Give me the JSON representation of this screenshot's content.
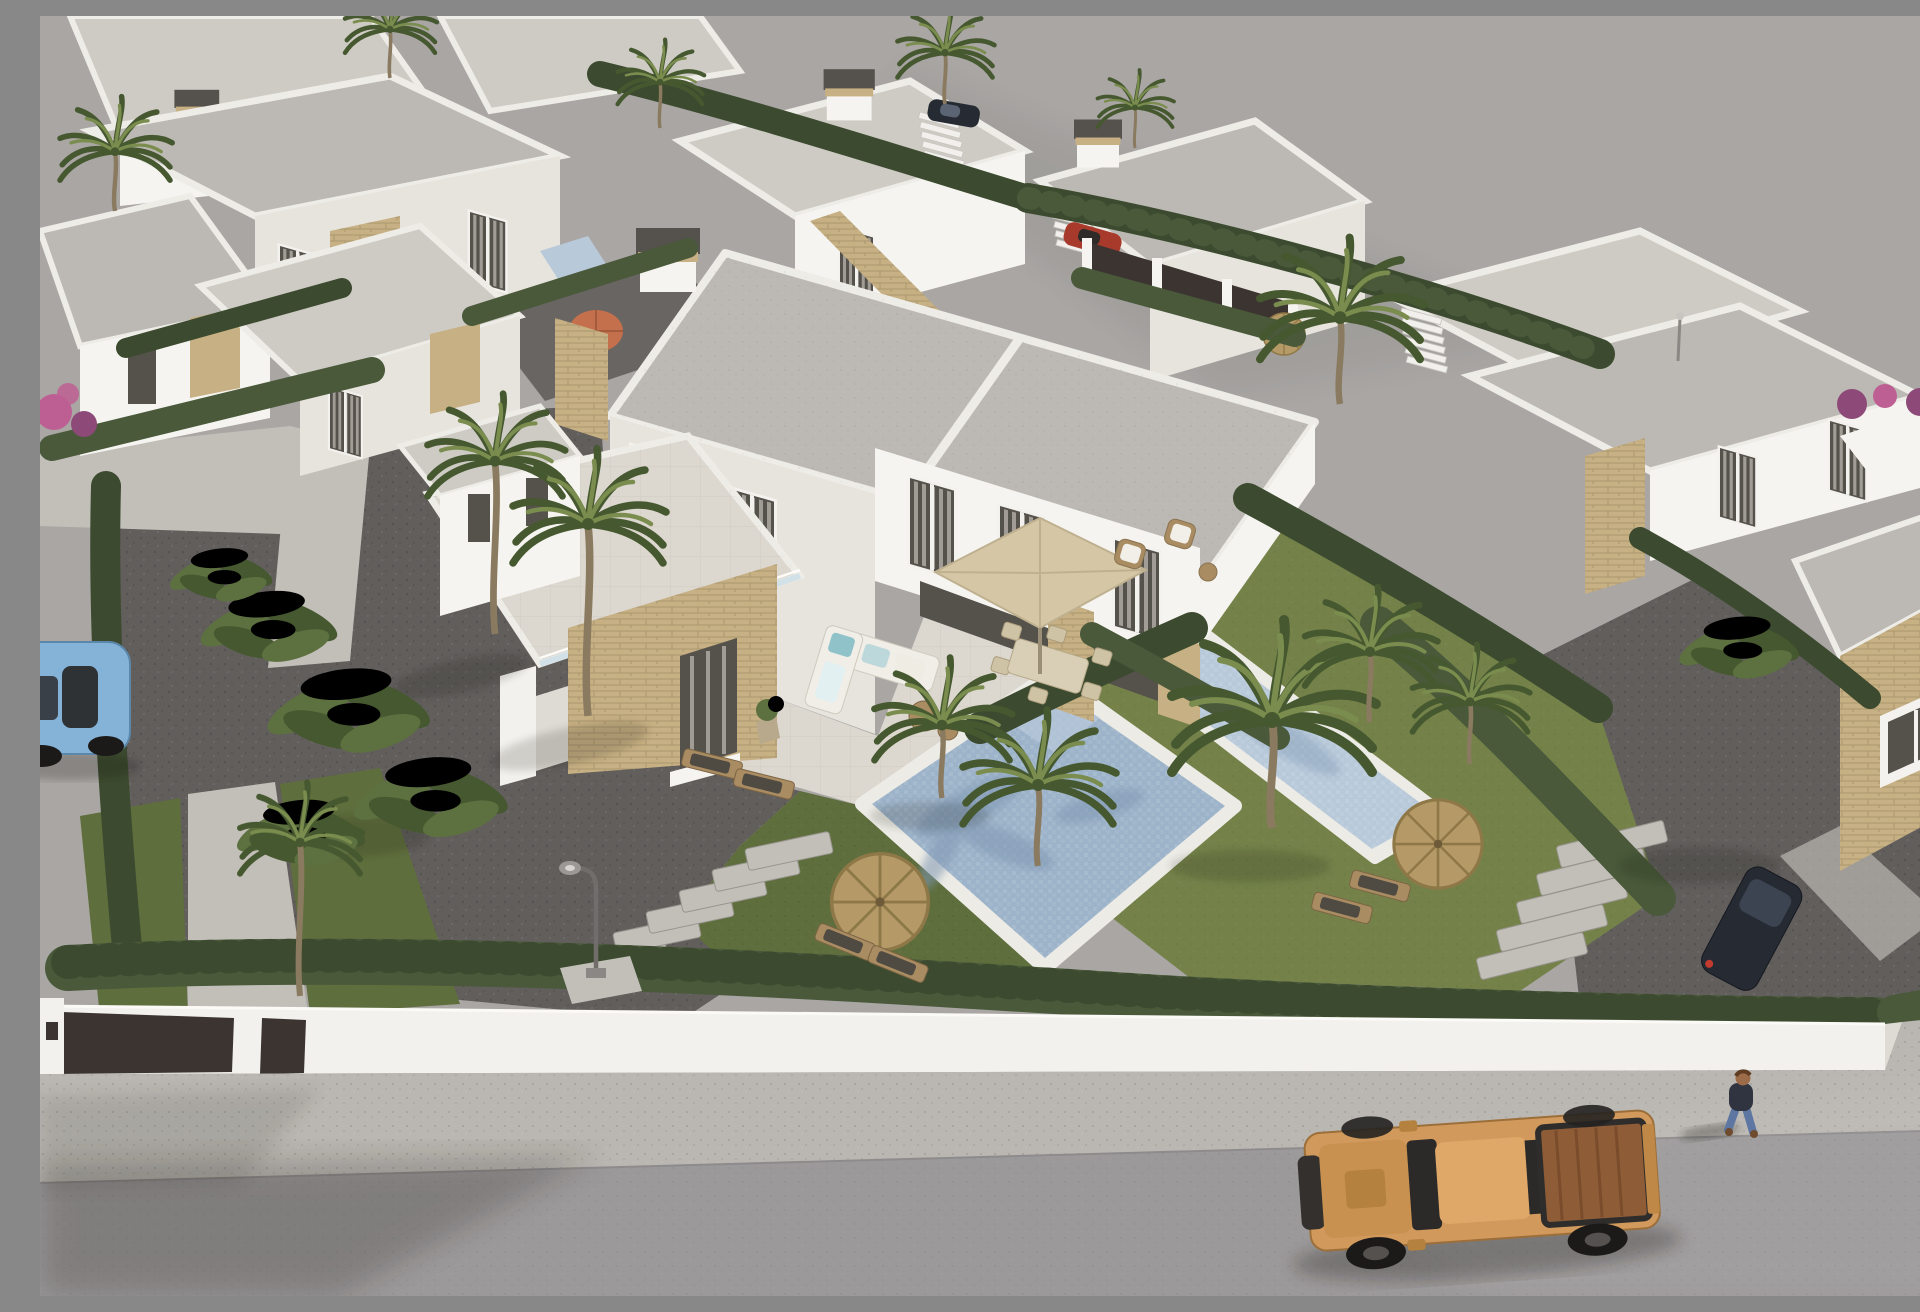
{
  "scene": {
    "title": "Aerial 3D architectural rendering of a modern white villa development",
    "description": "Photorealistic bird's-eye render of a residential complex of flat-roofed white villas with sandstone accent walls. A central two-storey duplex villa has a tiled terrace, an L-shaped outdoor sofa, a square beige parasol over a dining set, sun loungers, a mosaic-tiled swimming pool and a lawn with a straw parasol. A second elongated pool lies in the neighbouring garden to the right. Rows of cypress hedges, fan palms and banana plants divide the plots. A white perimeter wall with dark entrance gates runs along a grey asphalt street where a tan pickup truck drives past; a light-blue convertible is parked at the left edge and a pedestrian walks on the sidewalk at the lower right. The upper right of the frame is an empty grey lot.",
    "style": "photorealistic 3D visualization",
    "camera": "high aerial three-quarter view",
    "time_of_day": "bright daylight, low warm sun from the right"
  },
  "palette": {
    "bgGround": "#a9a6a4",
    "street": "#9c999a",
    "sidewalk": "#bab7b2",
    "curb": "#8e8b8c",
    "wallWhite": "#f3f1ed",
    "wallShade": "#dedbd5",
    "gateDark": "#3b3430",
    "gravelDark": "#615e5c",
    "gravelLight": "#b3b0ab",
    "pathLight": "#c2bfb9",
    "lawn": "#5f6e3d",
    "lawnLight": "#74824a",
    "hedge": "#49593a",
    "hedgeDark": "#3c4b2f",
    "roofGray": "#bcb9b4",
    "roofLight": "#cecbc5",
    "whiteWall": "#f6f4f0",
    "whiteShade": "#e7e4de",
    "whiteDark": "#d7d4cd",
    "parapet": "#eeece7",
    "stoneTan": "#c7b083",
    "stoneDark": "#a8906a",
    "glassDark": "#55514b",
    "curtain": "#b5b1a9",
    "glassBlue": "#cfe0e8",
    "deck": "#dcd7cf",
    "deckWarm": "#d2cdc4",
    "poolBlue": "#9db3c9",
    "poolLight": "#b8c9da",
    "poolDark": "#7e97b2",
    "coping": "#ecebe5",
    "umbBeige": "#d5c7a5",
    "umbStraw": "#b59a67",
    "umbStrawDark": "#8f7848",
    "umbOrange": "#c4704c",
    "woodTan": "#a98c62",
    "truckOrange": "#d1995c",
    "truckDark": "#33302d",
    "truckBed": "#8e5c36",
    "carBlue": "#85b3d8",
    "carRed": "#a83a2c",
    "carDark": "#262a33",
    "skin": "#9c6b4a",
    "navyShirt": "#2f3440",
    "jeans": "#5d77a2",
    "whiteShirt": "#e9e7e3",
    "pink": "#bd5f93",
    "purple": "#8d4a78",
    "trunk": "#8a7a5f",
    "palmGreen": "#5d7040",
    "palmDark": "#46582f",
    "palmLight": "#7a8d4e"
  },
  "objects": {
    "central_villa": {
      "label": "central duplex villa",
      "features": [
        "flat gravel roof with white parapets and centre divider",
        "dark chimney cap with stone collar",
        "two-storey white facade with tall curtained windows",
        "sandstone accent volume with dark doorway",
        "roof terrace with glass balustrade over single-storey annex",
        "recessed terrace with stone piers"
      ]
    },
    "pools": [
      {
        "name": "central-pool",
        "description": "square mosaic-tiled pool with palm shadow on the water and white coping"
      },
      {
        "name": "right-garden-pool",
        "description": "elongated mosaic pool in the neighbouring garden"
      },
      {
        "name": "background-plunge-pool",
        "description": "small plunge pool in the rear garden with orange parasol"
      }
    ],
    "furniture": [
      {
        "name": "outdoor-sofa",
        "description": "white L-shaped lounge sofa with teal cushions and two round coffee tables"
      },
      {
        "name": "dining-parasol",
        "description": "square beige cantilever parasol over an outdoor dining table with chairs"
      },
      {
        "name": "armchair-set",
        "description": "two rattan armchairs with white cushions on the raised terrace"
      },
      {
        "name": "deck-loungers",
        "description": "pair of beige sun loungers on the terrace"
      },
      {
        "name": "straw-parasol-central",
        "description": "round straw parasol with two wooden loungers on the lawn"
      },
      {
        "name": "straw-parasol-right",
        "description": "round straw parasol with wooden loungers in the right garden"
      },
      {
        "name": "straw-parasol-back",
        "description": "small straw parasol in the rear courtyard"
      },
      {
        "name": "potted-plants",
        "description": "potted green plants by the terrace doors"
      }
    ],
    "vehicles": [
      {
        "name": "pickup-truck",
        "description": "tan double-cab pickup truck with open bed driving left along the street",
        "position": "bottom centre-right"
      },
      {
        "name": "convertible",
        "description": "light-blue convertible parked at the kerb, partly out of frame",
        "position": "middle left edge"
      },
      {
        "name": "red-car",
        "description": "red car parked behind the dark courtyard fence",
        "position": "upper centre"
      },
      {
        "name": "dark-car",
        "description": "dark car parked beyond the boundary hedge",
        "position": "top centre"
      },
      {
        "name": "dark-suv",
        "description": "dark SUV on the neighbouring driveway beneath a palm",
        "position": "right, above the street"
      }
    ],
    "people": [
      {
        "name": "pedestrian",
        "description": "person with brown hair, dark top and blue jeans walking on the sidewalk",
        "position": "lower right"
      },
      {
        "name": "pedestrian-partial",
        "description": "second pedestrian in a white top clipped by the right frame edge",
        "position": "right edge"
      }
    ],
    "street_elements": [
      {
        "name": "perimeter-wall",
        "description": "white rendered boundary wall with two dark entrance gate panels and an intercom pillar"
      },
      {
        "name": "street-hedge",
        "description": "continuous cypress hedge running above the wall"
      },
      {
        "name": "sidewalk",
        "description": "light speckled concrete sidewalk"
      },
      {
        "name": "asphalt-street",
        "description": "grey asphalt road with soft shadows"
      },
      {
        "name": "street-lamp",
        "description": "curved-head garden lamp beside the stepping-stone path"
      },
      {
        "name": "stepping-stones",
        "description": "two diagonal stepping-stone paths crossing the gravel"
      }
    ],
    "vegetation": {
      "palms": "fan palms scattered through all gardens, tall slender palms by the entrance",
      "banana_plants": "large banana-leaf cluster in the left garden",
      "hedges": "clipped cypress hedge rows dividing every plot",
      "flowers": "pink and purple bougainvillea at the left edge and on the right boundary"
    },
    "background": {
      "villas": "rows of white flat-roofed villas with sandstone accents, roof-terrace stairs and chimneys",
      "empty_lot": "plain grey unbuilt ground occupying the upper right of the frame"
    }
  },
  "counts": {
    "villas_visible": 12,
    "swimming_pools": 3,
    "parasols": 6,
    "vehicles": 5,
    "people": 2
  }
}
